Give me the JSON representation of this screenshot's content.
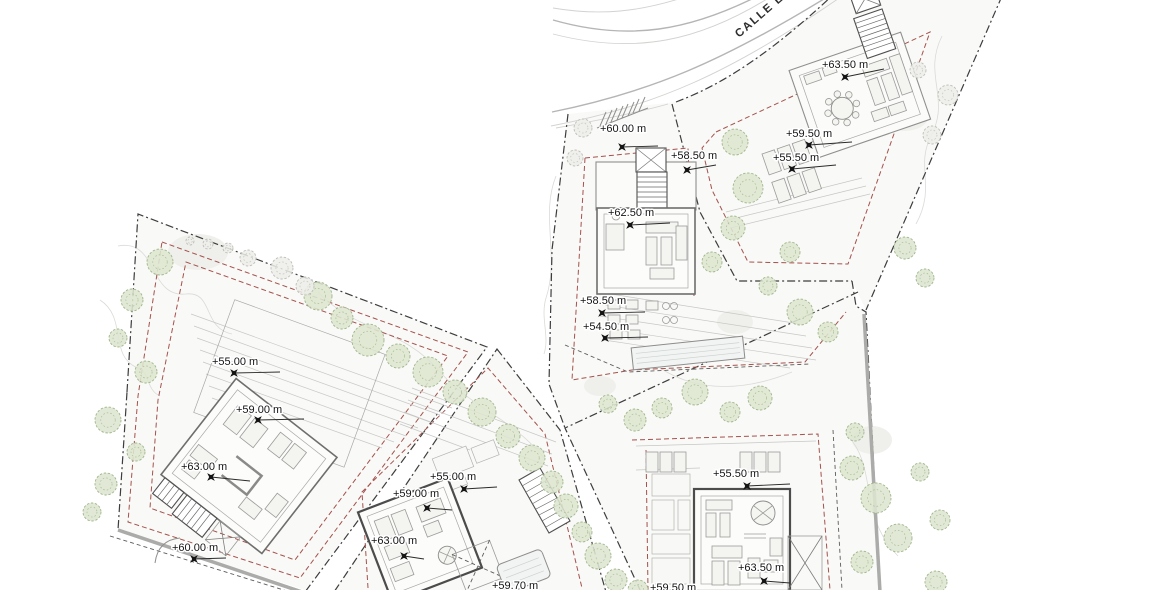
{
  "street": {
    "label": "CALLE LL"
  },
  "colors": {
    "boundary": "#3d3d3d",
    "setback": "#a4524d",
    "road": "#b5b5b5",
    "label": "#141414",
    "tree_fill": "#dde6d0",
    "tree_stroke": "#9fb68c",
    "tree_gray_fill": "#ededea",
    "tree_gray_stroke": "#bcbeb8"
  },
  "elevation_labels": [
    {
      "text": "+60.00 m",
      "tx": 600,
      "ty": 132,
      "mx": 622,
      "my": 147,
      "lx": 658,
      "ly": 146
    },
    {
      "text": "+58.50 m",
      "tx": 671,
      "ty": 159,
      "mx": 687,
      "my": 170,
      "lx": 716,
      "ly": 165
    },
    {
      "text": "+62.50 m",
      "tx": 608,
      "ty": 216,
      "mx": 630,
      "my": 225,
      "lx": 670,
      "ly": 223
    },
    {
      "text": "+58.50 m",
      "tx": 580,
      "ty": 304,
      "mx": 602,
      "my": 313,
      "lx": 645,
      "ly": 312
    },
    {
      "text": "+54.50 m",
      "tx": 583,
      "ty": 330,
      "mx": 605,
      "my": 338,
      "lx": 648,
      "ly": 337
    },
    {
      "text": "+63.50 m",
      "tx": 822,
      "ty": 68,
      "mx": 845,
      "my": 77,
      "lx": 884,
      "ly": 69
    },
    {
      "text": "+59.50 m",
      "tx": 786,
      "ty": 137,
      "mx": 809,
      "my": 145,
      "lx": 852,
      "ly": 142
    },
    {
      "text": "+55.50 m",
      "tx": 773,
      "ty": 161,
      "mx": 792,
      "my": 169,
      "lx": 836,
      "ly": 165
    },
    {
      "text": "+55.00 m",
      "tx": 212,
      "ty": 365,
      "mx": 234,
      "my": 373,
      "lx": 280,
      "ly": 372
    },
    {
      "text": "+59.00 m",
      "tx": 236,
      "ty": 413,
      "mx": 258,
      "my": 420,
      "lx": 304,
      "ly": 419
    },
    {
      "text": "+63.00 m",
      "tx": 181,
      "ty": 470,
      "mx": 211,
      "my": 477,
      "lx": 250,
      "ly": 481
    },
    {
      "text": "+60.00 m",
      "tx": 172,
      "ty": 551,
      "mx": 194,
      "my": 559,
      "lx": 226,
      "ly": 558
    },
    {
      "text": "+55.00 m",
      "tx": 430,
      "ty": 480,
      "mx": 464,
      "my": 489,
      "lx": 497,
      "ly": 487
    },
    {
      "text": "+59.00 m",
      "tx": 393,
      "ty": 497,
      "mx": 427,
      "my": 508,
      "lx": 452,
      "ly": 510
    },
    {
      "text": "+63.00 m",
      "tx": 371,
      "ty": 544,
      "mx": 404,
      "my": 556,
      "lx": 424,
      "ly": 559
    },
    {
      "text": "+59.70 m",
      "tx": 492,
      "ty": 589
    },
    {
      "text": "+55.50 m",
      "tx": 713,
      "ty": 477,
      "mx": 747,
      "my": 486,
      "lx": 790,
      "ly": 484
    },
    {
      "text": "+63.50 m",
      "tx": 738,
      "ty": 571,
      "mx": 764,
      "my": 581,
      "lx": 790,
      "ly": 583
    },
    {
      "text": "+59.50 m",
      "tx": 650,
      "ty": 591
    }
  ],
  "trees": [
    [
      318,
      296,
      14,
      "g"
    ],
    [
      342,
      318,
      11,
      "g"
    ],
    [
      368,
      340,
      16,
      "g"
    ],
    [
      398,
      356,
      12,
      "g"
    ],
    [
      428,
      372,
      15,
      "g"
    ],
    [
      455,
      392,
      12,
      "g"
    ],
    [
      482,
      412,
      14,
      "g"
    ],
    [
      508,
      436,
      12,
      "g"
    ],
    [
      532,
      458,
      13,
      "g"
    ],
    [
      552,
      482,
      11,
      "g"
    ],
    [
      566,
      506,
      12,
      "g"
    ],
    [
      582,
      532,
      10,
      "g"
    ],
    [
      598,
      556,
      13,
      "g"
    ],
    [
      616,
      580,
      11,
      "g"
    ],
    [
      638,
      590,
      10,
      "g"
    ],
    [
      160,
      262,
      13,
      "g"
    ],
    [
      132,
      300,
      11,
      "g"
    ],
    [
      118,
      338,
      9,
      "g"
    ],
    [
      146,
      372,
      11,
      "g"
    ],
    [
      108,
      420,
      13,
      "g"
    ],
    [
      136,
      452,
      9,
      "g"
    ],
    [
      106,
      484,
      11,
      "g"
    ],
    [
      92,
      512,
      9,
      "g"
    ],
    [
      282,
      268,
      11,
      "k"
    ],
    [
      248,
      258,
      8,
      "k"
    ],
    [
      228,
      248,
      5,
      "k"
    ],
    [
      208,
      244,
      5,
      "k"
    ],
    [
      305,
      286,
      9,
      "k"
    ],
    [
      190,
      241,
      4,
      "k"
    ],
    [
      583,
      128,
      9,
      "k"
    ],
    [
      575,
      158,
      8,
      "k"
    ],
    [
      735,
      142,
      13,
      "g"
    ],
    [
      748,
      188,
      15,
      "g"
    ],
    [
      733,
      228,
      12,
      "g"
    ],
    [
      712,
      262,
      10,
      "g"
    ],
    [
      800,
      312,
      13,
      "g"
    ],
    [
      828,
      332,
      10,
      "g"
    ],
    [
      760,
      398,
      12,
      "g"
    ],
    [
      730,
      412,
      10,
      "g"
    ],
    [
      695,
      392,
      13,
      "g"
    ],
    [
      662,
      408,
      10,
      "g"
    ],
    [
      635,
      420,
      11,
      "g"
    ],
    [
      608,
      404,
      9,
      "g"
    ],
    [
      905,
      248,
      11,
      "g"
    ],
    [
      925,
      278,
      9,
      "g"
    ],
    [
      948,
      95,
      10,
      "k"
    ],
    [
      932,
      135,
      9,
      "k"
    ],
    [
      918,
      70,
      8,
      "k"
    ],
    [
      852,
      468,
      12,
      "g"
    ],
    [
      876,
      498,
      15,
      "g"
    ],
    [
      898,
      538,
      14,
      "g"
    ],
    [
      862,
      562,
      11,
      "g"
    ],
    [
      920,
      472,
      9,
      "g"
    ],
    [
      936,
      582,
      11,
      "g"
    ],
    [
      940,
      520,
      10,
      "g"
    ],
    [
      855,
      432,
      9,
      "g"
    ],
    [
      790,
      252,
      10,
      "g"
    ],
    [
      768,
      286,
      9,
      "g"
    ]
  ]
}
